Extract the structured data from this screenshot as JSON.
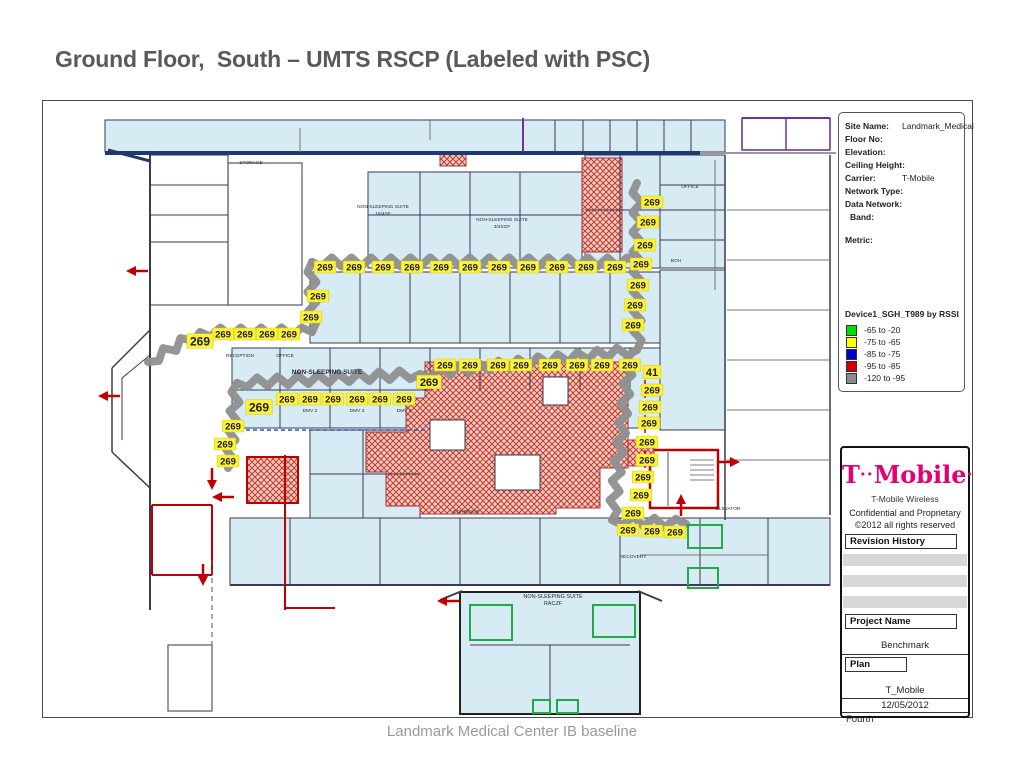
{
  "slide": {
    "title": "Ground Floor,  South – UMTS RSCP (Labeled with PSC)",
    "footer": "Landmark Medical Center IB baseline"
  },
  "site_info": {
    "rows": [
      {
        "label": "Site Name:",
        "value": "Landmark_Medical"
      },
      {
        "label": "Floor No:",
        "value": ""
      },
      {
        "label": "Elevation:",
        "value": ""
      },
      {
        "label": "Ceiling Height:",
        "value": ""
      },
      {
        "label": "Carrier:",
        "value": "T-Mobile"
      },
      {
        "label": "Network Type:",
        "value": ""
      },
      {
        "label": "Data Network:",
        "value": ""
      },
      {
        "label": "Band:",
        "value": "",
        "indent": true
      },
      {
        "label": "Metric:",
        "value": "",
        "gap": true
      }
    ]
  },
  "legend": {
    "title": "Device1_SGH_T989 by RSSI",
    "items": [
      {
        "color": "#00e000",
        "label": "-65 to -20"
      },
      {
        "color": "#ffff00",
        "label": "-75 to -65"
      },
      {
        "color": "#0000cc",
        "label": "-85 to -75"
      },
      {
        "color": "#d40000",
        "label": "-95 to -85"
      },
      {
        "color": "#8c8c8c",
        "label": "-120 to -95"
      }
    ]
  },
  "title_block": {
    "brand_t": "T",
    "brand_dots": "··",
    "brand_name": "Mobile",
    "brand_end": "·",
    "subtitle": "T-Mobile Wireless",
    "confidential": "Confidential and Proprietary",
    "copyright": "©2012 all rights reserved",
    "revision_label": "Revision History",
    "project_label": "Project Name",
    "project_value": "Benchmark",
    "plan_label": "Plan",
    "plan_value": "T_Mobile",
    "date": "12/05/2012",
    "floor": "Fourth"
  },
  "floorplan": {
    "psc_value": "269",
    "colors": {
      "route": "#8f8f8f",
      "label_bg": "#fcf23c",
      "label_border": "#d8cf00",
      "room": "#d6ebf4",
      "wall": "#3a3a52",
      "navy": "#1f3a6e",
      "purple": "#7030a0",
      "red": "#c00000",
      "green": "#1faa4a",
      "hatch_line": "#c23b2e",
      "hatch_bg": "#eccbc2"
    },
    "rooms": [
      [
        105,
        120,
        450,
        32,
        "blue"
      ],
      [
        555,
        120,
        170,
        32,
        "blue"
      ],
      [
        742,
        118,
        88,
        32,
        "white"
      ],
      [
        368,
        172,
        214,
        96,
        "blue"
      ],
      [
        585,
        155,
        140,
        113,
        "blue"
      ],
      [
        228,
        163,
        74,
        142,
        "white"
      ],
      [
        150,
        155,
        78,
        150,
        "white"
      ],
      [
        310,
        272,
        415,
        71,
        "blue"
      ],
      [
        232,
        348,
        428,
        80,
        "blue"
      ],
      [
        660,
        270,
        65,
        160,
        "blue"
      ],
      [
        310,
        430,
        110,
        88,
        "blue"
      ],
      [
        230,
        518,
        600,
        67,
        "blue"
      ],
      [
        768,
        518,
        62,
        67,
        "blue"
      ],
      [
        460,
        592,
        180,
        122,
        "blue2"
      ],
      [
        168,
        645,
        44,
        66,
        "white"
      ],
      [
        650,
        450,
        68,
        58,
        "stair"
      ]
    ],
    "walls": [
      [
        105,
        153,
        700,
        153,
        "navy",
        4
      ],
      [
        700,
        153,
        836,
        153,
        "#999",
        2
      ],
      [
        108,
        150,
        150,
        161,
        "navy",
        3
      ],
      [
        523,
        118,
        523,
        152,
        "purple",
        2
      ],
      [
        583,
        120,
        583,
        152,
        "wall",
        1
      ],
      [
        610,
        120,
        610,
        152,
        "wall",
        1
      ],
      [
        637,
        120,
        637,
        152,
        "wall",
        1
      ],
      [
        664,
        120,
        664,
        152,
        "wall",
        1
      ],
      [
        691,
        120,
        691,
        152,
        "wall",
        1
      ],
      [
        300,
        128,
        300,
        152,
        "#777",
        1
      ],
      [
        430,
        120,
        430,
        140,
        "#777",
        1
      ],
      [
        420,
        172,
        420,
        268,
        "wall",
        1
      ],
      [
        470,
        172,
        470,
        268,
        "wall",
        1
      ],
      [
        520,
        172,
        520,
        268,
        "wall",
        1
      ],
      [
        368,
        215,
        582,
        215,
        "wall",
        1
      ],
      [
        620,
        155,
        620,
        268,
        "wall",
        1
      ],
      [
        585,
        210,
        725,
        210,
        "wall",
        1
      ],
      [
        660,
        155,
        660,
        268,
        "wall",
        1
      ],
      [
        660,
        185,
        725,
        185,
        "wall",
        1
      ],
      [
        660,
        240,
        725,
        240,
        "wall",
        1
      ],
      [
        150,
        185,
        228,
        185,
        "wall",
        1
      ],
      [
        150,
        215,
        228,
        215,
        "wall",
        1
      ],
      [
        150,
        242,
        228,
        242,
        "wall",
        1
      ],
      [
        360,
        272,
        360,
        343,
        "wall",
        1
      ],
      [
        410,
        272,
        410,
        343,
        "wall",
        1
      ],
      [
        460,
        272,
        460,
        343,
        "wall",
        1
      ],
      [
        510,
        272,
        510,
        343,
        "wall",
        1
      ],
      [
        560,
        272,
        560,
        343,
        "wall",
        1
      ],
      [
        610,
        272,
        610,
        343,
        "wall",
        1
      ],
      [
        280,
        348,
        280,
        428,
        "wall",
        1
      ],
      [
        330,
        348,
        330,
        428,
        "wall",
        1
      ],
      [
        380,
        348,
        380,
        428,
        "wall",
        1
      ],
      [
        430,
        348,
        430,
        390,
        "wall",
        1
      ],
      [
        480,
        348,
        480,
        390,
        "wall",
        1
      ],
      [
        530,
        348,
        530,
        390,
        "wall",
        1
      ],
      [
        580,
        348,
        580,
        390,
        "wall",
        1
      ],
      [
        630,
        348,
        630,
        390,
        "wall",
        1
      ],
      [
        232,
        390,
        430,
        390,
        "wall",
        1
      ],
      [
        232,
        430,
        425,
        430,
        "#2255cc",
        1.5,
        "4 3"
      ],
      [
        645,
        380,
        645,
        480,
        "red",
        1.5,
        "4 3"
      ],
      [
        725,
        155,
        725,
        520,
        "wall",
        1.5
      ],
      [
        830,
        155,
        830,
        515,
        "wall",
        1.5
      ],
      [
        727,
        210,
        830,
        210,
        "#777",
        1
      ],
      [
        727,
        260,
        830,
        260,
        "#777",
        1
      ],
      [
        727,
        310,
        830,
        310,
        "#777",
        1
      ],
      [
        727,
        360,
        830,
        360,
        "#777",
        1
      ],
      [
        727,
        410,
        830,
        410,
        "#777",
        1
      ],
      [
        727,
        460,
        830,
        460,
        "#777",
        1
      ],
      [
        715,
        160,
        715,
        290,
        "#777",
        1
      ],
      [
        150,
        330,
        112,
        368,
        "wall",
        1.5
      ],
      [
        112,
        368,
        112,
        452,
        "wall",
        1.5
      ],
      [
        112,
        452,
        150,
        488,
        "wall",
        1.5
      ],
      [
        150,
        355,
        122,
        378,
        "wall",
        1
      ],
      [
        122,
        378,
        122,
        440,
        "wall",
        1
      ],
      [
        150,
        155,
        150,
        610,
        "wall",
        2
      ],
      [
        285,
        455,
        285,
        610,
        "red",
        2
      ],
      [
        285,
        608,
        335,
        608,
        "red",
        2
      ],
      [
        152,
        505,
        212,
        505,
        "red",
        2
      ],
      [
        152,
        505,
        152,
        575,
        "red",
        2
      ],
      [
        212,
        505,
        212,
        575,
        "red",
        2
      ],
      [
        152,
        575,
        212,
        575,
        "red",
        2
      ],
      [
        290,
        518,
        290,
        585,
        "wall",
        1
      ],
      [
        380,
        518,
        380,
        585,
        "wall",
        1
      ],
      [
        460,
        518,
        460,
        585,
        "wall",
        1
      ],
      [
        540,
        518,
        540,
        585,
        "wall",
        1
      ],
      [
        620,
        518,
        620,
        585,
        "wall",
        1
      ],
      [
        700,
        518,
        700,
        585,
        "wall",
        1
      ],
      [
        768,
        518,
        768,
        585,
        "wall",
        1
      ],
      [
        230,
        585,
        830,
        585,
        "wall",
        2
      ],
      [
        212,
        560,
        212,
        712,
        "#555",
        1,
        "5 4"
      ],
      [
        470,
        645,
        630,
        645,
        "wall",
        1
      ],
      [
        550,
        645,
        550,
        715,
        "wall",
        1
      ],
      [
        640,
        555,
        768,
        555,
        "#777",
        1
      ],
      [
        742,
        118,
        830,
        118,
        "purple",
        2
      ],
      [
        742,
        118,
        742,
        150,
        "purple",
        1.5
      ],
      [
        786,
        118,
        786,
        150,
        "purple",
        1.5
      ],
      [
        830,
        118,
        830,
        150,
        "purple",
        1.5
      ],
      [
        742,
        150,
        830,
        150,
        "purple",
        1.5
      ],
      [
        310,
        474,
        420,
        474,
        "wall",
        1
      ],
      [
        363,
        430,
        363,
        518,
        "wall",
        1
      ],
      [
        440,
        600,
        462,
        591,
        "wall",
        2
      ],
      [
        638,
        591,
        662,
        601,
        "wall",
        2
      ],
      [
        690,
        460,
        714,
        460,
        "#555",
        0.8
      ],
      [
        690,
        465,
        714,
        465,
        "#555",
        0.8
      ],
      [
        690,
        470,
        714,
        470,
        "#555",
        0.8
      ],
      [
        690,
        475,
        714,
        475,
        "#555",
        0.8
      ],
      [
        690,
        480,
        714,
        480,
        "#555",
        0.8
      ],
      [
        668,
        452,
        668,
        506,
        "#555",
        1
      ]
    ],
    "hatch_poly": [
      [
        425,
        362
      ],
      [
        628,
        362
      ],
      [
        628,
        468
      ],
      [
        600,
        468
      ],
      [
        600,
        508
      ],
      [
        556,
        508
      ],
      [
        556,
        514
      ],
      [
        420,
        514
      ],
      [
        420,
        506
      ],
      [
        386,
        506
      ],
      [
        386,
        472
      ],
      [
        366,
        472
      ],
      [
        366,
        432
      ],
      [
        406,
        432
      ],
      [
        406,
        398
      ],
      [
        425,
        398
      ]
    ],
    "hatch_rects": [
      [
        582,
        158,
        40,
        94
      ],
      [
        628,
        440,
        26,
        26
      ],
      [
        247,
        457,
        51,
        46,
        "red"
      ],
      [
        440,
        154,
        26,
        12
      ]
    ],
    "cutouts": [
      [
        543,
        377,
        25,
        28
      ],
      [
        495,
        455,
        45,
        35
      ],
      [
        430,
        420,
        35,
        30
      ]
    ],
    "routes": [
      [
        [
          637,
          183
        ],
        [
          637,
          350
        ]
      ],
      [
        [
          312,
          262
        ],
        [
          637,
          262
        ]
      ],
      [
        [
          312,
          262
        ],
        [
          312,
          332
        ]
      ],
      [
        [
          312,
          332
        ],
        [
          200,
          332
        ],
        [
          148,
          362
        ]
      ],
      [
        [
          237,
          383
        ],
        [
          420,
          374
        ],
        [
          637,
          350
        ]
      ],
      [
        [
          630,
          355
        ],
        [
          612,
          520
        ]
      ],
      [
        [
          612,
          520
        ],
        [
          686,
          524
        ]
      ],
      [
        [
          237,
          383
        ],
        [
          228,
          468
        ]
      ]
    ],
    "green_boxes": [
      [
        470,
        605,
        42,
        35
      ],
      [
        593,
        605,
        42,
        32
      ],
      [
        533,
        700,
        17,
        13
      ],
      [
        557,
        700,
        21,
        13
      ],
      [
        688,
        568,
        30,
        20
      ],
      [
        688,
        525,
        34,
        23
      ]
    ],
    "psc_labels": [
      [
        325,
        267
      ],
      [
        354,
        267
      ],
      [
        383,
        267
      ],
      [
        412,
        267
      ],
      [
        441,
        267
      ],
      [
        470,
        267
      ],
      [
        499,
        267
      ],
      [
        528,
        267
      ],
      [
        557,
        267
      ],
      [
        586,
        267
      ],
      [
        615,
        267
      ],
      [
        318,
        296
      ],
      [
        311,
        317
      ],
      [
        652,
        202
      ],
      [
        648,
        222
      ],
      [
        645,
        245
      ],
      [
        641,
        264
      ],
      [
        638,
        285
      ],
      [
        635,
        305
      ],
      [
        633,
        325
      ],
      [
        223,
        334
      ],
      [
        245,
        334
      ],
      [
        267,
        334
      ],
      [
        289,
        334
      ],
      [
        200,
        341,
        "269",
        12
      ],
      [
        287,
        399
      ],
      [
        310,
        399
      ],
      [
        333,
        399
      ],
      [
        357,
        399
      ],
      [
        380,
        399
      ],
      [
        404,
        399
      ],
      [
        259,
        407,
        "269",
        12
      ],
      [
        445,
        365
      ],
      [
        470,
        365
      ],
      [
        498,
        365
      ],
      [
        521,
        365
      ],
      [
        550,
        365
      ],
      [
        577,
        365
      ],
      [
        602,
        365
      ],
      [
        630,
        365
      ],
      [
        652,
        372,
        "41",
        11
      ],
      [
        429,
        382,
        "269",
        11
      ],
      [
        652,
        390
      ],
      [
        650,
        407
      ],
      [
        649,
        423
      ],
      [
        647,
        442
      ],
      [
        647,
        460
      ],
      [
        643,
        477
      ],
      [
        641,
        495
      ],
      [
        633,
        513
      ],
      [
        628,
        530
      ],
      [
        652,
        531
      ],
      [
        675,
        532
      ],
      [
        233,
        426
      ],
      [
        225,
        444
      ],
      [
        228,
        461
      ]
    ],
    "arrows": [
      [
        138,
        271,
        "left"
      ],
      [
        110,
        396,
        "left"
      ],
      [
        212,
        478,
        "down"
      ],
      [
        224,
        497,
        "left"
      ],
      [
        203,
        574,
        "down"
      ],
      [
        728,
        462,
        "right"
      ],
      [
        681,
        506,
        "up"
      ],
      [
        449,
        601,
        "left"
      ]
    ],
    "room_labels": [
      [
        251,
        164,
        "STORAGE"
      ],
      [
        690,
        188,
        "OFFICE"
      ],
      [
        383,
        208,
        "NON-SLEEPING SUITE"
      ],
      [
        383,
        215,
        "16/4SF"
      ],
      [
        502,
        221,
        "NON-SLEEPING SUITE"
      ],
      [
        502,
        228,
        "3/4SGF"
      ],
      [
        240,
        357,
        "RECEPTION"
      ],
      [
        285,
        357,
        "OFFICE"
      ],
      [
        297,
        374,
        "18",
        5,
        "red"
      ],
      [
        327,
        374,
        "NON-SLEEPING SUITE",
        6.5
      ],
      [
        310,
        412,
        "DMV 2"
      ],
      [
        357,
        412,
        "DMV 3"
      ],
      [
        404,
        412,
        "DMV 4"
      ],
      [
        466,
        513,
        "CORRIDOR"
      ],
      [
        728,
        510,
        "ELEVATOR"
      ],
      [
        676,
        262,
        "BOH"
      ],
      [
        633,
        558,
        "RECOVERY"
      ],
      [
        553,
        598,
        "NON-SLEEPING SUITE",
        5.5
      ],
      [
        553,
        605,
        "RACZF",
        5.5
      ]
    ]
  }
}
